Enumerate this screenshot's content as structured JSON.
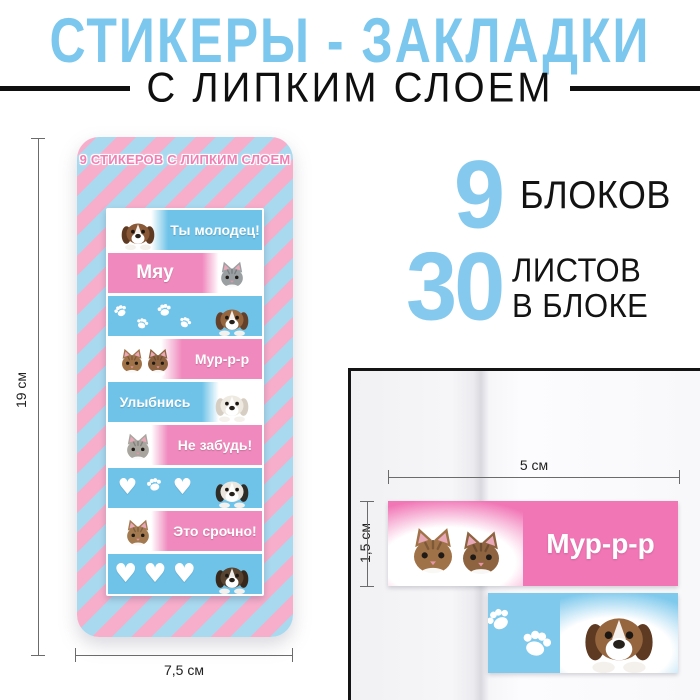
{
  "header": {
    "title": "СТИКЕРЫ - ЗАКЛАДКИ",
    "subtitle": "С ЛИПКИМ СЛОЕМ"
  },
  "product": {
    "label": "9 СТИКЕРОВ С ЛИПКИМ СЛОЕМ",
    "stickers": [
      {
        "bg": "blue",
        "text": "Ты молодец!",
        "animal": "puppy",
        "animal_side": "left"
      },
      {
        "bg": "pink",
        "text": "Мяу",
        "animal": "kitten",
        "animal_side": "right"
      },
      {
        "bg": "blue",
        "text": "",
        "icons": "paw,paw,paw,paw,paw",
        "animal": "puppy",
        "animal_side": "right"
      },
      {
        "bg": "pink",
        "text": "Мур-р-р",
        "animal": "two-kittens",
        "animal_side": "left"
      },
      {
        "bg": "blue",
        "text": "Улыбнись",
        "animal": "white-puppy",
        "animal_side": "right"
      },
      {
        "bg": "pink",
        "text": "Не забудь!",
        "animal": "kitten",
        "animal_side": "left"
      },
      {
        "bg": "blue",
        "text": "",
        "icons": "heart,paw,heart",
        "animal": "black-white-puppy",
        "animal_side": "right"
      },
      {
        "bg": "pink",
        "text": "Это срочно!",
        "animal": "kitten",
        "animal_side": "left"
      },
      {
        "bg": "blue",
        "text": "",
        "icons": "heart,heart,heart",
        "animal": "dark-puppy",
        "animal_side": "right"
      }
    ],
    "dimensions": {
      "height": "19 см",
      "width": "7,5 см"
    }
  },
  "specs": {
    "blocks": {
      "value": "9",
      "label": "БЛОКОВ"
    },
    "sheets": {
      "value": "30",
      "label_line1": "ЛИСТОВ",
      "label_line2": "В БЛОКЕ"
    }
  },
  "closeup": {
    "pink_sticker_text": "Мур-р-р",
    "width_label": "5 см",
    "height_label": "1,5 см"
  },
  "icons": {
    "heart": "♥"
  },
  "colors": {
    "title_blue": "#7cc7ee",
    "number_blue": "#85caee",
    "stripe_pink": "#f6aecb",
    "stripe_blue": "#a9d9ef",
    "sticker_pink": "#f089bd",
    "sticker_blue": "#6fc3e9",
    "closeup_pink": "#f176b6",
    "closeup_blue": "#7ec9ec",
    "text_black": "#0f0f0f"
  }
}
